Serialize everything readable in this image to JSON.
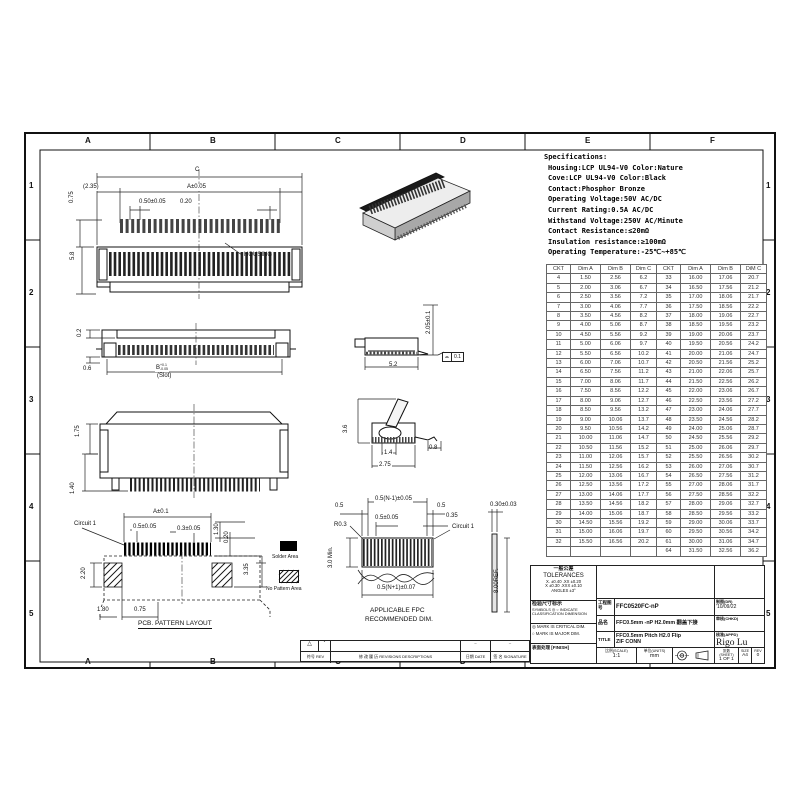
{
  "sheet": {
    "letters": [
      "A",
      "B",
      "C",
      "D",
      "E",
      "F"
    ],
    "numbers": [
      "1",
      "2",
      "3",
      "4",
      "5"
    ]
  },
  "specs": {
    "title": "Specifications:",
    "lines": [
      "Housing:LCP UL94-V0 Color:Nature",
      "Cove:LCP UL94-V0 Color:Black",
      "Contact:Phosphor Bronze",
      "Operating Voltage:50V AC/DC",
      "Current Rating:0.5A AC/DC",
      "Withstand Voltage:250V AC/Minute",
      "Contact Resistance:≤20mΩ",
      "Insulation resistance:≥100mΩ",
      "Operating Temperature:-25℃~+85℃"
    ]
  },
  "ckt_table": {
    "headers": [
      "CKT",
      "Dim A",
      "Dim B",
      "Dim C",
      "CKT",
      "Dim A",
      "Dim B",
      "DiM C"
    ],
    "rows": [
      [
        "4",
        "1.50",
        "2.56",
        "6.2",
        "33",
        "16.00",
        "17.06",
        "20.7"
      ],
      [
        "5",
        "2.00",
        "3.06",
        "6.7",
        "34",
        "16.50",
        "17.56",
        "21.2"
      ],
      [
        "6",
        "2.50",
        "3.56",
        "7.2",
        "35",
        "17.00",
        "18.06",
        "21.7"
      ],
      [
        "7",
        "3.00",
        "4.06",
        "7.7",
        "36",
        "17.50",
        "18.56",
        "22.2"
      ],
      [
        "8",
        "3.50",
        "4.56",
        "8.2",
        "37",
        "18.00",
        "19.06",
        "22.7"
      ],
      [
        "9",
        "4.00",
        "5.06",
        "8.7",
        "38",
        "18.50",
        "19.56",
        "23.2"
      ],
      [
        "10",
        "4.50",
        "5.56",
        "9.2",
        "39",
        "19.00",
        "20.06",
        "23.7"
      ],
      [
        "11",
        "5.00",
        "6.06",
        "9.7",
        "40",
        "19.50",
        "20.56",
        "24.2"
      ],
      [
        "12",
        "5.50",
        "6.56",
        "10.2",
        "41",
        "20.00",
        "21.06",
        "24.7"
      ],
      [
        "13",
        "6.00",
        "7.06",
        "10.7",
        "42",
        "20.50",
        "21.56",
        "25.2"
      ],
      [
        "14",
        "6.50",
        "7.56",
        "11.2",
        "43",
        "21.00",
        "22.06",
        "25.7"
      ],
      [
        "15",
        "7.00",
        "8.06",
        "11.7",
        "44",
        "21.50",
        "22.56",
        "26.2"
      ],
      [
        "16",
        "7.50",
        "8.56",
        "12.2",
        "45",
        "22.00",
        "23.06",
        "26.7"
      ],
      [
        "17",
        "8.00",
        "9.06",
        "12.7",
        "46",
        "22.50",
        "23.56",
        "27.2"
      ],
      [
        "18",
        "8.50",
        "9.56",
        "13.2",
        "47",
        "23.00",
        "24.06",
        "27.7"
      ],
      [
        "19",
        "9.00",
        "10.06",
        "13.7",
        "48",
        "23.50",
        "24.56",
        "28.2"
      ],
      [
        "20",
        "9.50",
        "10.56",
        "14.2",
        "49",
        "24.00",
        "25.06",
        "28.7"
      ],
      [
        "21",
        "10.00",
        "11.06",
        "14.7",
        "50",
        "24.50",
        "25.56",
        "29.2"
      ],
      [
        "22",
        "10.50",
        "11.56",
        "15.2",
        "51",
        "25.00",
        "26.06",
        "29.7"
      ],
      [
        "23",
        "11.00",
        "12.06",
        "15.7",
        "52",
        "25.50",
        "26.56",
        "30.2"
      ],
      [
        "24",
        "11.50",
        "12.56",
        "16.2",
        "53",
        "26.00",
        "27.06",
        "30.7"
      ],
      [
        "25",
        "12.00",
        "13.06",
        "16.7",
        "54",
        "26.50",
        "27.56",
        "31.2"
      ],
      [
        "26",
        "12.50",
        "13.56",
        "17.2",
        "55",
        "27.00",
        "28.06",
        "31.7"
      ],
      [
        "27",
        "13.00",
        "14.06",
        "17.7",
        "56",
        "27.50",
        "28.56",
        "32.2"
      ],
      [
        "28",
        "13.50",
        "14.56",
        "18.2",
        "57",
        "28.00",
        "29.06",
        "32.7"
      ],
      [
        "29",
        "14.00",
        "15.06",
        "18.7",
        "58",
        "28.50",
        "29.56",
        "33.2"
      ],
      [
        "30",
        "14.50",
        "15.56",
        "19.2",
        "59",
        "29.00",
        "30.06",
        "33.7"
      ],
      [
        "31",
        "15.00",
        "16.06",
        "19.7",
        "60",
        "29.50",
        "30.56",
        "34.2"
      ],
      [
        "32",
        "15.50",
        "16.56",
        "20.2",
        "61",
        "30.00",
        "31.06",
        "34.7"
      ],
      [
        "",
        "",
        "",
        "",
        "64",
        "31.50",
        "32.56",
        "36.2"
      ]
    ]
  },
  "views": {
    "top_view": {
      "dim_c": "C",
      "dim_235": "(2.35)",
      "dim_a": "A±0.05",
      "dim_050": "0.50±0.05",
      "dim_020": "0.20",
      "dim_075": "0.75",
      "dim_58": "5.8",
      "housing": "HOUSING"
    },
    "front_view": {
      "dim_02": "0.2",
      "dim_06": "0.6",
      "dim_b_base": "B",
      "dim_b_up": "+0.1",
      "dim_b_dn": "-0.05",
      "slot": "(Slot)"
    },
    "rear_view": {
      "dim_175": "1.75",
      "dim_140": "1.40"
    },
    "side_view": {
      "dim_205": "2.05±0.1",
      "dim_52": "5.2",
      "flatness_symbol": "⌓",
      "flatness": "0.1"
    },
    "flip_view": {
      "dim_36": "3.6",
      "dim_14": "1.4",
      "dim_275": "2.75",
      "dim_08": "0.8"
    },
    "pcb_layout": {
      "circuit1": "Circuit 1",
      "dim_a": "A±0.1",
      "dim_05": "0.5±0.05",
      "dim_03": "0.3±0.05",
      "dim_130": "1.30",
      "dim_020": "0.20",
      "dim_220": "2.20",
      "dim_335": "3.35",
      "dim_180": "1.80",
      "dim_075": "0.75",
      "title": "PCB. PATTERN LAYOUT"
    },
    "fpc_view": {
      "dim_top": "0.5(N-1)±0.05",
      "dim_05l": "0.5",
      "dim_05r": "0.5",
      "dim_0505": "0.5±0.05",
      "dim_035": "0.35",
      "r03": "R0.3",
      "circuit1": "Circuit 1",
      "dim_30min": "3.0 Min.",
      "dim_bottom": "0.5(N+1)±0.07",
      "caption1": "APPLICABLE FPC",
      "caption2": "RECOMMENDED DIM.",
      "dim_030": "0.30±0.03",
      "dim_800": "8.00REF."
    }
  },
  "legend": {
    "solder": "Solder Area",
    "no_pattern": "No Pattern Area"
  },
  "title_block": {
    "tolerances": {
      "cn": "一般公差",
      "en": "TOLERANCES",
      "l1": "X. ±0.40   .XX ±0.20",
      "l2": "X  ±0.30  .XXX ±0.10",
      "l3": "ANGLES  ±3°"
    },
    "inspection": {
      "cn": "检验尺寸标示",
      "l1": "SYMBOLS ◎ ○ INDICATE",
      "l2": "CLASSIFICATION DIMENSION"
    },
    "marks": {
      "l1": "◎ MARK IS CRITICAL DIM.",
      "l2": "○ MARK IS MAJOR DIM."
    },
    "finish": {
      "label": "表面处理 [FINISH]"
    },
    "part_no": {
      "label": "工程图号",
      "value": "FFC0520FC-nP"
    },
    "product": {
      "label": "品名",
      "value": "FFC0.5mm -nP H2.0mm 翻盖下接"
    },
    "title": {
      "label": "TITLE",
      "value1": "FFC0.5mm Pitch H2.0 Flip",
      "value2": "ZIF CONN"
    },
    "scale": {
      "label": "比例(SCALE)",
      "value": "1:1"
    },
    "units": {
      "label": "单位(UNITS)",
      "value": "mm"
    },
    "dr": {
      "label": "制图(DR)",
      "value": "'10/09/22"
    },
    "chkd": {
      "label": "审核(CHKD)",
      "value": ""
    },
    "appd": {
      "label": "核准(APPD)",
      "value": "Rigo Lu"
    },
    "sheet_no": {
      "label": "张数(SHEET)",
      "value": "1 OF 1"
    },
    "size": {
      "label": "SIZE",
      "value": "A4"
    },
    "rev": {
      "label": "REV",
      "value": "0"
    }
  },
  "revision": {
    "mark": "△",
    "star": "*",
    "dash1": "–",
    "dash2": "–",
    "col_rev": "符号 REV",
    "col_desc": "修 改 履 历  REVISIONS DESCRIPTIONS",
    "col_date": "日期 DATE",
    "col_sign": "签 名 SIGNATURE"
  }
}
